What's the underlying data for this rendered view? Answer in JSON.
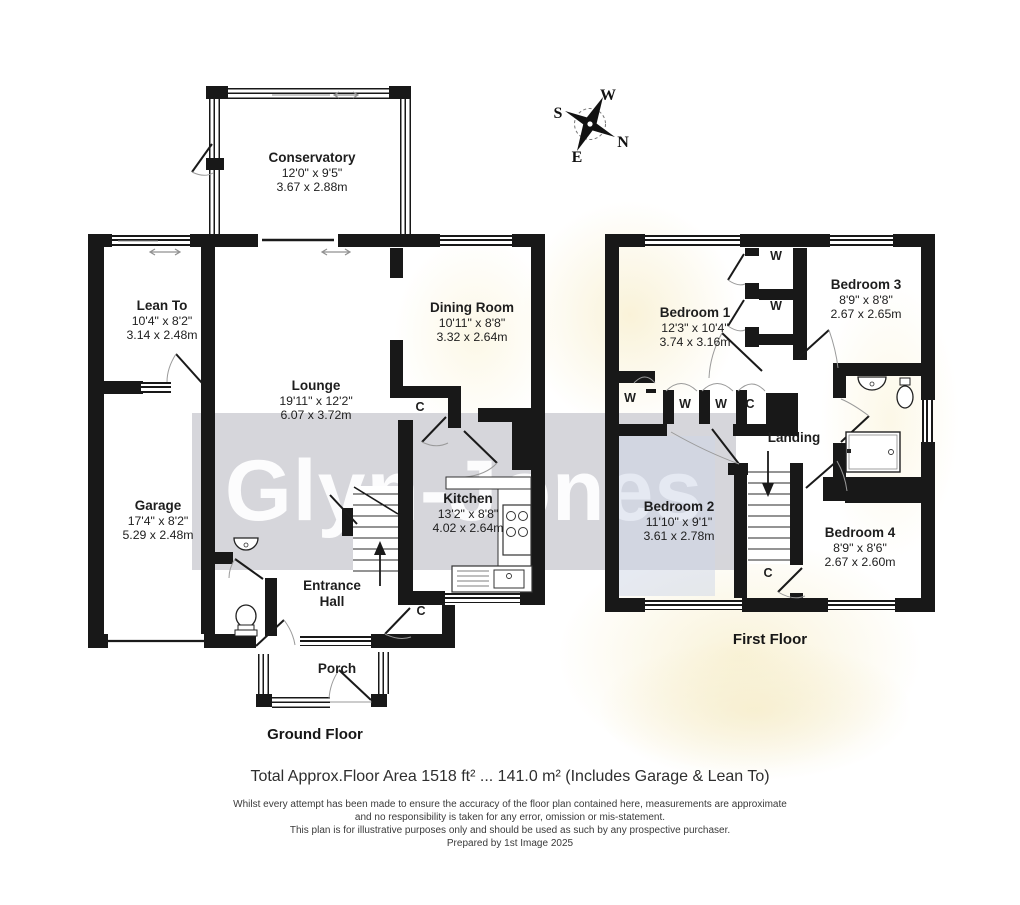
{
  "watermark_text": "Glyn-Jones",
  "compass": {
    "n": "N",
    "e": "E",
    "s": "S",
    "w": "W"
  },
  "ground_floor": {
    "title": "Ground Floor",
    "rooms": {
      "conservatory": {
        "name": "Conservatory",
        "imperial": "12'0\" x 9'5\"",
        "metric": "3.67 x 2.88m"
      },
      "lean_to": {
        "name": "Lean To",
        "imperial": "10'4\" x 8'2\"",
        "metric": "3.14 x 2.48m"
      },
      "lounge": {
        "name": "Lounge",
        "imperial": "19'11\" x 12'2\"",
        "metric": "6.07 x 3.72m"
      },
      "dining_room": {
        "name": "Dining Room",
        "imperial": "10'11\" x 8'8\"",
        "metric": "3.32 x 2.64m"
      },
      "garage": {
        "name": "Garage",
        "imperial": "17'4\" x 8'2\"",
        "metric": "5.29 x 2.48m"
      },
      "kitchen": {
        "name": "Kitchen",
        "imperial": "13'2\" x 8'8\"",
        "metric": "4.02 x 2.64m"
      },
      "entrance_hall": {
        "name": "Entrance Hall"
      },
      "porch": {
        "name": "Porch"
      }
    },
    "cupboards": [
      "C",
      "C"
    ]
  },
  "first_floor": {
    "title": "First Floor",
    "rooms": {
      "bedroom1": {
        "name": "Bedroom 1",
        "imperial": "12'3\" x 10'4\"",
        "metric": "3.74 x 3.16m"
      },
      "bedroom2": {
        "name": "Bedroom 2",
        "imperial": "11'10\" x 9'1\"",
        "metric": "3.61 x 2.78m"
      },
      "bedroom3": {
        "name": "Bedroom 3",
        "imperial": "8'9\" x 8'8\"",
        "metric": "2.67 x 2.65m"
      },
      "bedroom4": {
        "name": "Bedroom 4",
        "imperial": "8'9\" x 8'6\"",
        "metric": "2.67 x 2.60m"
      },
      "landing": {
        "name": "Landing"
      }
    },
    "wardrobes": [
      "W",
      "W",
      "W",
      "W",
      "W"
    ],
    "cupboards": [
      "C",
      "C"
    ]
  },
  "footer": {
    "area_summary": "Total Approx.Floor Area 1518 ft² ... 141.0 m² (Includes Garage & Lean To)",
    "disclaimer": [
      "Whilst every attempt has been made to ensure the accuracy of the floor plan contained here, measurements are approximate",
      "and no responsibility is taken for any error, omission or mis-statement.",
      "This plan is for illustrative purposes only and should be used as such by any prospective purchaser.",
      "Prepared by 1st Image 2025"
    ]
  }
}
